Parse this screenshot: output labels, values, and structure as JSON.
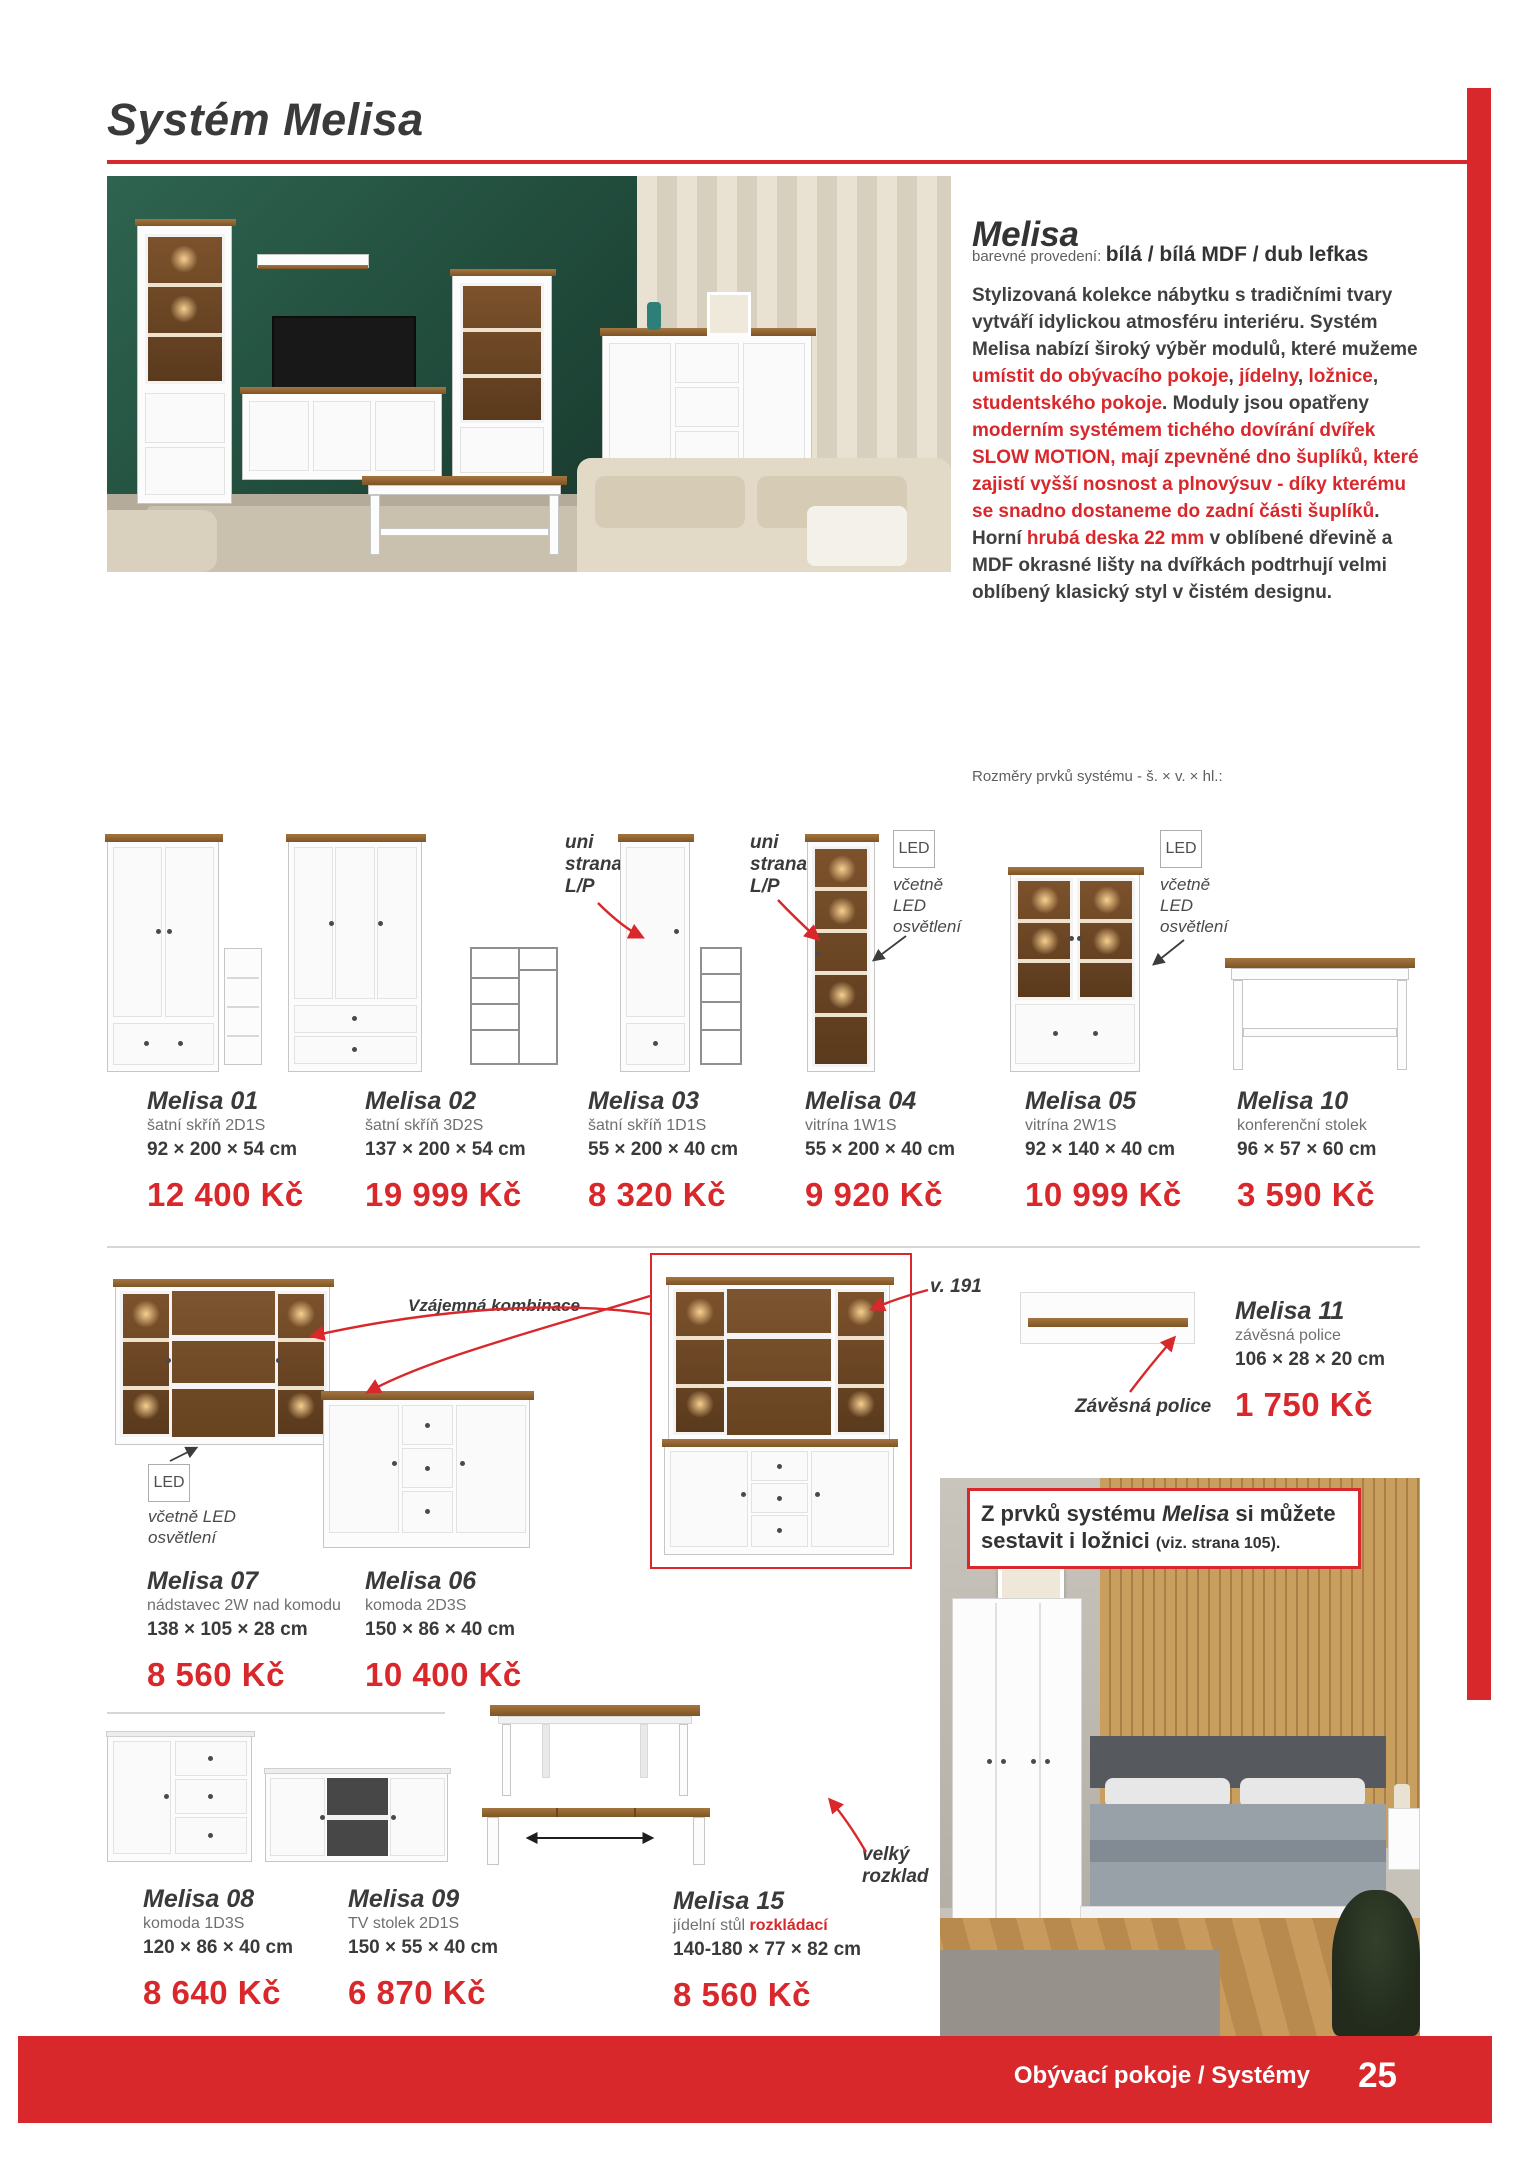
{
  "page": {
    "title": "Systém Melisa",
    "footer_label": "Obývací pokoje / Systémy",
    "page_number": "25"
  },
  "colors": {
    "accent": "#d8282c",
    "ink": "#3c3c3c"
  },
  "intro": {
    "heading": "Melisa",
    "colors_label": "barevné provedení:",
    "colors_value": "bílá / bílá MDF / dub lefkas",
    "description": [
      {
        "text": "Stylizovaná kolekce nábytku s tradičními tvary vytváří idylickou atmosféru interiéru. Systém Melisa nabízí široký výběr modulů, které mužeme ",
        "cls": ""
      },
      {
        "text": "umístit do obývacího pokoje",
        "cls": "red"
      },
      {
        "text": ", ",
        "cls": ""
      },
      {
        "text": "jídelny",
        "cls": "red"
      },
      {
        "text": ", ",
        "cls": ""
      },
      {
        "text": "ložnice",
        "cls": "red"
      },
      {
        "text": ", ",
        "cls": ""
      },
      {
        "text": "studentského pokoje",
        "cls": "red"
      },
      {
        "text": ". Moduly jsou opatřeny ",
        "cls": ""
      },
      {
        "text": "moderním systémem tichého dovírání dvířek SLOW MOTION, mají zpevněné dno šuplíků, které zajistí vyšší nosnost a plnovýsuv - díky kterému se snadno dostaneme do zadní části šuplíků",
        "cls": "red"
      },
      {
        "text": ". Horní ",
        "cls": ""
      },
      {
        "text": "hrubá deska 22 mm",
        "cls": "red"
      },
      {
        "text": " v oblíbené dřevině a MDF okrasné lišty na dvířkách podtrhují velmi oblíbený klasický styl v čistém designu.",
        "cls": ""
      }
    ],
    "dimensions_note": "Rozměry prvků systému - š. × v. × hl.:"
  },
  "products": [
    {
      "name": "Melisa 01",
      "subtitle": "šatní skříň 2D1S",
      "dims": "92 × 200 × 54 cm",
      "price": "12 400 Kč"
    },
    {
      "name": "Melisa 02",
      "subtitle": "šatní skříň 3D2S",
      "dims": "137 × 200 × 54 cm",
      "price": "19 999 Kč"
    },
    {
      "name": "Melisa 03",
      "subtitle": "šatní skříň 1D1S",
      "dims": "55 × 200 × 40 cm",
      "price": "8 320 Kč"
    },
    {
      "name": "Melisa 04",
      "subtitle": "vitrína 1W1S",
      "dims": "55 × 200 × 40 cm",
      "price": "9 920 Kč"
    },
    {
      "name": "Melisa 05",
      "subtitle": "vitrína 2W1S",
      "dims": "92 × 140 × 40 cm",
      "price": "10 999 Kč"
    },
    {
      "name": "Melisa 10",
      "subtitle": "konferenční stolek",
      "dims": "96 × 57 × 60 cm",
      "price": "3 590 Kč"
    },
    {
      "name": "Melisa 07",
      "subtitle": "nádstavec 2W nad komodu",
      "dims": "138 × 105 × 28 cm",
      "price": "8 560 Kč"
    },
    {
      "name": "Melisa 06",
      "subtitle": "komoda 2D3S",
      "dims": "150 × 86 × 40 cm",
      "price": "10 400 Kč"
    },
    {
      "name": "Melisa 11",
      "subtitle": "závěsná police",
      "dims": "106 × 28 × 20 cm",
      "price": "1 750 Kč"
    },
    {
      "name": "Melisa 08",
      "subtitle": "komoda 1D3S",
      "dims": "120 × 86 × 40 cm",
      "price": "8 640 Kč"
    },
    {
      "name": "Melisa 09",
      "subtitle": "TV stolek 2D1S",
      "dims": "150 × 55 × 40 cm",
      "price": "6 870 Kč"
    },
    {
      "name": "Melisa 15",
      "subtitle_rich": [
        {
          "text": "jídelní stůl ",
          "cls": ""
        },
        {
          "text": "rozkládací",
          "cls": "red-bold"
        }
      ],
      "dims": "140-180 × 77 × 82 cm",
      "price": "8 560 Kč"
    }
  ],
  "annotations": {
    "uni_strana": "uni strana L/P",
    "led_badge": "LED",
    "led_note": "včetně LED osvětlení",
    "combination": "Vzájemná kombinace",
    "height_note": "v. 191",
    "hanging_shelf": "Závěsná police",
    "table_extend": "velký rozklad"
  },
  "promo": {
    "segments": [
      {
        "text": "Z prvků systému ",
        "cls": ""
      },
      {
        "text": "Melisa",
        "cls": "italic"
      },
      {
        "text": " si můžete sestavit i ložnici ",
        "cls": ""
      },
      {
        "text": "(viz. strana 105).",
        "cls": "small"
      }
    ]
  }
}
